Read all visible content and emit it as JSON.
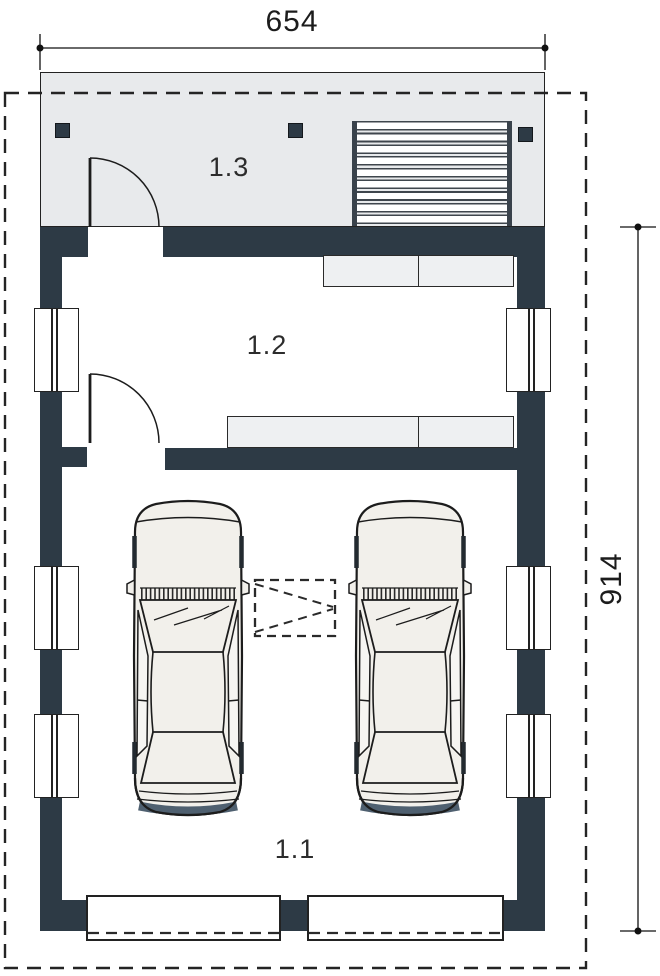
{
  "plan": {
    "width_dimension": "654",
    "height_dimension": "914",
    "rooms": [
      {
        "label": "1.1"
      },
      {
        "label": "1.2"
      },
      {
        "label": "1.3"
      }
    ]
  },
  "icons": {
    "car": "car-top-view-icon",
    "door_swing": "door-swing-arc-icon",
    "window": "window-symbol-icon",
    "hatch_box": "dashed-hatch-opening-icon",
    "louvers": "slatted-screen-icon"
  },
  "colors": {
    "wall": "#2d3a45",
    "porch": "#e8eaec",
    "shelf": "#eef0f2",
    "line": "#1e1e1e",
    "carBody": "#f2f0eb",
    "carBumper": "#4f6070",
    "windowFill": "#ffffff"
  }
}
